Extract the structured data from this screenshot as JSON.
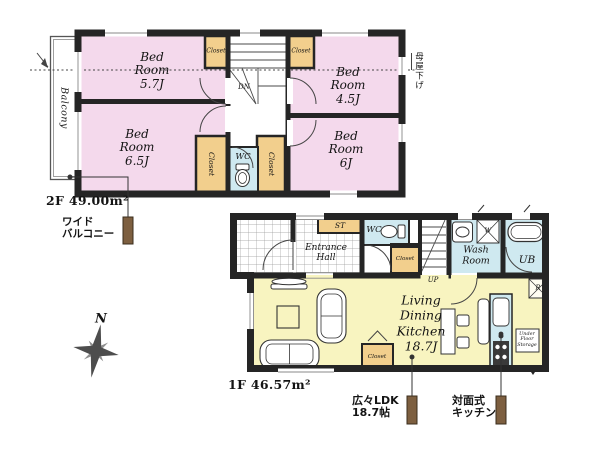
{
  "colors": {
    "wall": "#252525",
    "bedroom": "#f4d9ec",
    "ldk": "#f8f4c0",
    "closet": "#f2cf8d",
    "wet": "#cfe9f0",
    "marker": "#7d5f40"
  },
  "compass": {
    "north": "N"
  },
  "floor2": {
    "area_label": "2F 49.00m²",
    "balcony": "Balcony",
    "bed_57": "Bed\nRoom\n5.7J",
    "bed_45": "Bed\nRoom\n4.5J",
    "bed_65": "Bed\nRoom\n6.5J",
    "bed_6": "Bed\nRoom\n6J",
    "closet_nw": "Closet",
    "closet_ne": "Closet",
    "closet_w": "Closet",
    "closet_e": "Closet",
    "wc": "WC",
    "stairs": "DN",
    "roof_note": "母屋下げ",
    "balcony_note": "ワイド\nバルコニー"
  },
  "floor1": {
    "area_label": "1F 46.57m²",
    "entrance": "Entrance\nHall",
    "st": "ST",
    "wc": "WC",
    "closet_hall": "Closet",
    "closet_ldk": "Closet",
    "stairs": "UP",
    "washroom": "Wash\nRoom",
    "ub": "UB",
    "washer": "W",
    "fridge": "R",
    "ldk": "Living\nDining\nKitchen\n18.7J",
    "underfloor": "Under\nFloor\nStorage",
    "ldk_note": "広々LDK\n18.7帖",
    "kitchen_note": "対面式\nキッチン"
  }
}
